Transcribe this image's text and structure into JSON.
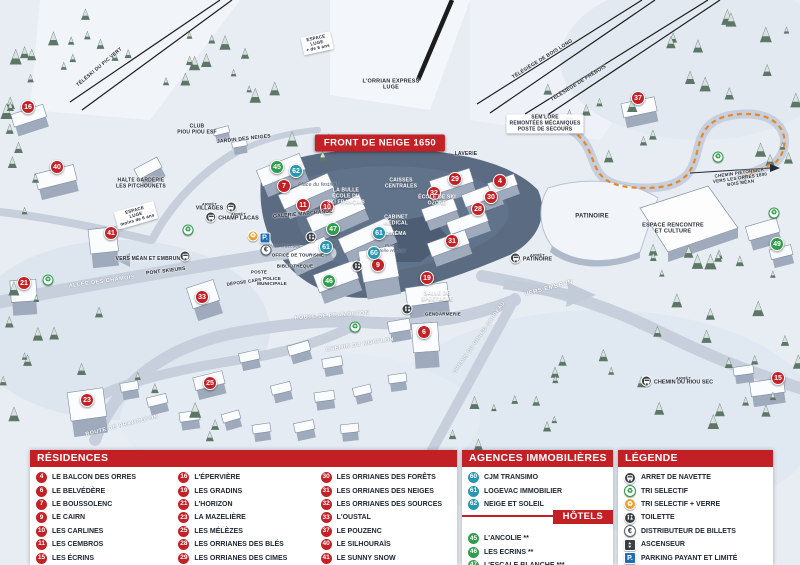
{
  "map": {
    "front_badge": "FRONT DE NEIGE 1650",
    "arret_label": "ARRÊT",
    "labels": [
      {
        "t": "TÉLÉSKI DU PIC VERT",
        "x": 100,
        "y": 68,
        "r": -40,
        "c": "dk",
        "s": 5
      },
      {
        "t": "L'ORRIAN EXPRESS\nLUGE",
        "x": 391,
        "y": 85,
        "c": "dk",
        "s": 5.5
      },
      {
        "t": "TÉLÉSIÈGE DE BOIS LONG",
        "x": 543,
        "y": 60,
        "r": -32,
        "c": "dk",
        "s": 5
      },
      {
        "t": "TÉLÉSIÈGE DE PRÉBOIS",
        "x": 579,
        "y": 84,
        "r": -32,
        "c": "dk",
        "s": 5
      },
      {
        "t": "SEM'LORE\nREMONTÉES MÉCANIQUES\nPOSTE DE SECOURS",
        "x": 545,
        "y": 124,
        "c": "sign",
        "s": 5
      },
      {
        "t": "ESPACE\nLUGE\n+ de 6 ans",
        "x": 317,
        "y": 43,
        "r": -12,
        "c": "sign",
        "s": 4.5
      },
      {
        "t": "CLUB\nPIOU PIOU ESF",
        "x": 197,
        "y": 130,
        "c": "dk",
        "s": 5
      },
      {
        "t": "JARDIN DES NEIGES",
        "x": 244,
        "y": 140,
        "r": -6,
        "c": "dk",
        "s": 5
      },
      {
        "t": "HALTE GARDERIE\nLES PITCHOUNETS",
        "x": 141,
        "y": 184,
        "c": "dk",
        "s": 5
      },
      {
        "t": "ESPACE\nLUGE\nmoins de 6 ans",
        "x": 136,
        "y": 215,
        "r": -16,
        "c": "sign",
        "s": 4.5
      },
      {
        "t": "VERS MÉAN ET EMBRUN",
        "x": 148,
        "y": 260,
        "c": "dk",
        "s": 5
      },
      {
        "t": "PONT SKIEURS",
        "x": 166,
        "y": 272,
        "r": -7,
        "c": "dk",
        "s": 5
      },
      {
        "t": "ALLÉE DES CHAMOIS",
        "x": 102,
        "y": 282,
        "r": -8,
        "c": "road",
        "s": 5.5
      },
      {
        "t": "Place du festival",
        "x": 318,
        "y": 186,
        "c": "it",
        "s": 5
      },
      {
        "t": "LA BULLE\nÉCOLE DU\nSKI FRANÇAIS",
        "x": 346,
        "y": 197,
        "c": "wh",
        "s": 5
      },
      {
        "t": "GALERIE MARCHANDE",
        "x": 303,
        "y": 215,
        "r": -5,
        "c": "dk",
        "s": 5
      },
      {
        "t": "CAISSES\nCENTRALES",
        "x": 401,
        "y": 184,
        "c": "wh",
        "s": 5
      },
      {
        "t": "CABINET\nMÉDICAL",
        "x": 396,
        "y": 221,
        "c": "wh",
        "s": 5
      },
      {
        "t": "CINÉMA",
        "x": 396,
        "y": 235,
        "c": "wh",
        "s": 5
      },
      {
        "t": "Place\nStelle Hodoul",
        "x": 391,
        "y": 248,
        "c": "it",
        "s": 4.5
      },
      {
        "t": "ÉCOLE DE SKI\nOZONE",
        "x": 437,
        "y": 201,
        "c": "wh",
        "s": 5
      },
      {
        "t": "LAVERIE",
        "x": 466,
        "y": 155,
        "c": "dk",
        "s": 5
      },
      {
        "t": "PATINOIRE",
        "x": 592,
        "y": 217,
        "c": "dk",
        "s": 6
      },
      {
        "t": "ESPACE RENCONTRE\nET CULTURE",
        "x": 673,
        "y": 229,
        "c": "dk",
        "s": 5.5
      },
      {
        "t": "VERS EMBRUN",
        "x": 549,
        "y": 289,
        "r": -15,
        "c": "road",
        "s": 6
      },
      {
        "t": "CHEMIN PIÉTONNIER\nVERS LES ORRES 1800\nBOIS MÉAN",
        "x": 740,
        "y": 178,
        "r": -8,
        "c": "dk",
        "s": 4.5
      },
      {
        "t": "SALLE DE\nSPECTACLE",
        "x": 437,
        "y": 297,
        "c": "wh",
        "s": 5
      },
      {
        "t": "GENDARMERIE",
        "x": 443,
        "y": 314,
        "c": "dk",
        "s": 4.5
      },
      {
        "t": "ROUTE DE PRAMOUTON",
        "x": 122,
        "y": 426,
        "r": -14,
        "c": "road",
        "s": 5.5
      },
      {
        "t": "ROUTE DE PRAMOUTON",
        "x": 332,
        "y": 316,
        "r": -4,
        "c": "road",
        "s": 5.5
      },
      {
        "t": "CHEMIN DU MOUFLON",
        "x": 360,
        "y": 345,
        "r": -9,
        "c": "road",
        "s": 5.5
      },
      {
        "t": "CHEMIN DU GRAND CORBEAU",
        "x": 480,
        "y": 338,
        "r": -55,
        "c": "road",
        "s": 5
      },
      {
        "t": "OFFICE DE TOURISME",
        "x": 298,
        "y": 255,
        "c": "dk",
        "s": 4.5
      },
      {
        "t": "BIBLIOTHÈQUE",
        "x": 295,
        "y": 266,
        "c": "dk",
        "s": 4.5
      },
      {
        "t": "POSTE",
        "x": 259,
        "y": 272,
        "c": "dk",
        "s": 4.5
      },
      {
        "t": "DÉPOSE CARS",
        "x": 244,
        "y": 282,
        "r": -8,
        "c": "dk",
        "s": 4.5
      },
      {
        "t": "POLICE\nMUNICIPALE",
        "x": 272,
        "y": 281,
        "c": "dk",
        "s": 4.5
      },
      {
        "t": "Place d'accueil",
        "x": 284,
        "y": 246,
        "c": "it",
        "s": 4.5
      }
    ],
    "markers": [
      {
        "n": "16",
        "c": "r",
        "x": 28,
        "y": 107
      },
      {
        "n": "40",
        "c": "r",
        "x": 57,
        "y": 167
      },
      {
        "n": "41",
        "c": "r",
        "x": 111,
        "y": 233
      },
      {
        "n": "21",
        "c": "r",
        "x": 24,
        "y": 283
      },
      {
        "n": "33",
        "c": "r",
        "x": 202,
        "y": 297
      },
      {
        "n": "25",
        "c": "r",
        "x": 210,
        "y": 383
      },
      {
        "n": "23",
        "c": "r",
        "x": 87,
        "y": 400
      },
      {
        "n": "7",
        "c": "r",
        "x": 284,
        "y": 186
      },
      {
        "n": "11",
        "c": "r",
        "x": 303,
        "y": 205
      },
      {
        "n": "10",
        "c": "r",
        "x": 327,
        "y": 207
      },
      {
        "n": "9",
        "c": "r",
        "x": 378,
        "y": 265
      },
      {
        "n": "19",
        "c": "r",
        "x": 427,
        "y": 278
      },
      {
        "n": "6",
        "c": "r",
        "x": 424,
        "y": 332
      },
      {
        "n": "37",
        "c": "r",
        "x": 638,
        "y": 98
      },
      {
        "n": "29",
        "c": "r",
        "x": 455,
        "y": 179
      },
      {
        "n": "4",
        "c": "r",
        "x": 500,
        "y": 181
      },
      {
        "n": "32",
        "c": "r",
        "x": 434,
        "y": 193
      },
      {
        "n": "30",
        "c": "r",
        "x": 491,
        "y": 197
      },
      {
        "n": "28",
        "c": "r",
        "x": 478,
        "y": 209
      },
      {
        "n": "31",
        "c": "r",
        "x": 452,
        "y": 241
      },
      {
        "n": "15",
        "c": "r",
        "x": 778,
        "y": 378
      },
      {
        "n": "45",
        "c": "g",
        "x": 277,
        "y": 167
      },
      {
        "n": "47",
        "c": "g",
        "x": 333,
        "y": 229
      },
      {
        "n": "46",
        "c": "g",
        "x": 329,
        "y": 281
      },
      {
        "n": "49",
        "c": "g",
        "x": 777,
        "y": 244
      },
      {
        "n": "62",
        "c": "b",
        "x": 296,
        "y": 171
      },
      {
        "n": "61",
        "c": "b",
        "x": 326,
        "y": 247
      },
      {
        "n": "61",
        "c": "b",
        "x": 379,
        "y": 233
      },
      {
        "n": "60",
        "c": "b",
        "x": 374,
        "y": 253
      }
    ],
    "icons": [
      {
        "t": "recycle",
        "x": 188,
        "y": 230
      },
      {
        "t": "recycle",
        "x": 48,
        "y": 280
      },
      {
        "t": "recycle",
        "x": 718,
        "y": 157
      },
      {
        "t": "recycle",
        "x": 355,
        "y": 327
      },
      {
        "t": "recycle",
        "x": 774,
        "y": 213
      },
      {
        "t": "recycle-o",
        "x": 253,
        "y": 236
      },
      {
        "t": "park",
        "x": 265,
        "y": 238
      },
      {
        "t": "euro",
        "x": 266,
        "y": 250
      },
      {
        "t": "toilet",
        "x": 311,
        "y": 237
      },
      {
        "t": "toilet",
        "x": 357,
        "y": 266
      },
      {
        "t": "toilet",
        "x": 407,
        "y": 309
      }
    ],
    "bus_stops": [
      {
        "l": "VILLAGES",
        "x": 216,
        "y": 207,
        "side": "l"
      },
      {
        "l": "CHAMP LACAS",
        "x": 232,
        "y": 217,
        "side": "r"
      },
      {
        "l": "",
        "x": 185,
        "y": 256,
        "side": "r"
      },
      {
        "l": "PATINOIRE",
        "x": 531,
        "y": 258,
        "side": "r"
      },
      {
        "l": "CHEMIN DU RIOU SEC",
        "x": 677,
        "y": 381,
        "side": "r"
      }
    ]
  },
  "legend": {
    "residences": {
      "title": "RÉSIDENCES",
      "items": [
        [
          "4",
          "LE BALCON DES ORRES"
        ],
        [
          "6",
          "LE BELVÉDÈRE"
        ],
        [
          "7",
          "LE BOUSSOLENC"
        ],
        [
          "9",
          "LE CAIRN"
        ],
        [
          "10",
          "LES CARLINES"
        ],
        [
          "11",
          "LES CEMBROS"
        ],
        [
          "15",
          "LES ÉCRINS"
        ],
        [
          "16",
          "L'ÉPERVIÈRE"
        ],
        [
          "19",
          "LES GRADINS"
        ],
        [
          "21",
          "L'HORIZON"
        ],
        [
          "23",
          "LA MAZELIÈRE"
        ],
        [
          "25",
          "LES MÉLÈZES"
        ],
        [
          "28",
          "LES ORRIANES DES BLÉS"
        ],
        [
          "29",
          "LES ORRIANES DES CIMES"
        ],
        [
          "30",
          "LES ORRIANES DES FORÊTS"
        ],
        [
          "31",
          "LES ORRIANES DES NEIGES"
        ],
        [
          "32",
          "LES ORRIANES DES SOURCES"
        ],
        [
          "33",
          "L'OUSTAL"
        ],
        [
          "37",
          "LE POUZENC"
        ],
        [
          "40",
          "LE SILHOURAÏS"
        ],
        [
          "41",
          "LE SUNNY SNOW"
        ]
      ]
    },
    "agences": {
      "title": "AGENCES IMMOBILIÈRES",
      "items": [
        [
          "60",
          "CJM TRANSIMO"
        ],
        [
          "61",
          "LOGEVAC IMMOBILIER"
        ],
        [
          "62",
          "NEIGE ET SOLEIL"
        ]
      ]
    },
    "hotels": {
      "title": "HÔTELS",
      "items": [
        [
          "45",
          "L'ANCOLIE **"
        ],
        [
          "46",
          "LES ECRINS **"
        ],
        [
          "47",
          "L'ESCALE BLANCHE ***"
        ],
        [
          "49",
          "LES TRAPPEURS **"
        ]
      ]
    },
    "legende": {
      "title": "LÉGENDE",
      "items": [
        [
          "bus",
          "ARRET DE NAVETTE"
        ],
        [
          "recycle",
          "TRI SELECTIF"
        ],
        [
          "recycle-o",
          "TRI SELECTIF + VERRE"
        ],
        [
          "toilet",
          "TOILETTE"
        ],
        [
          "euro",
          "DISTRIBUTEUR DE BILLETS"
        ],
        [
          "elev",
          "ASCENSEUR"
        ],
        [
          "park",
          "PARKING PAYANT ET LIMITÉ"
        ]
      ]
    }
  },
  "colors": {
    "residence_red": "#c42127",
    "agence_blue": "#2796b1",
    "hotel_green": "#2f9e4a",
    "header_red": "#c32026",
    "parking_blue": "#1d6eb5",
    "orange_path": "#e8872a"
  }
}
